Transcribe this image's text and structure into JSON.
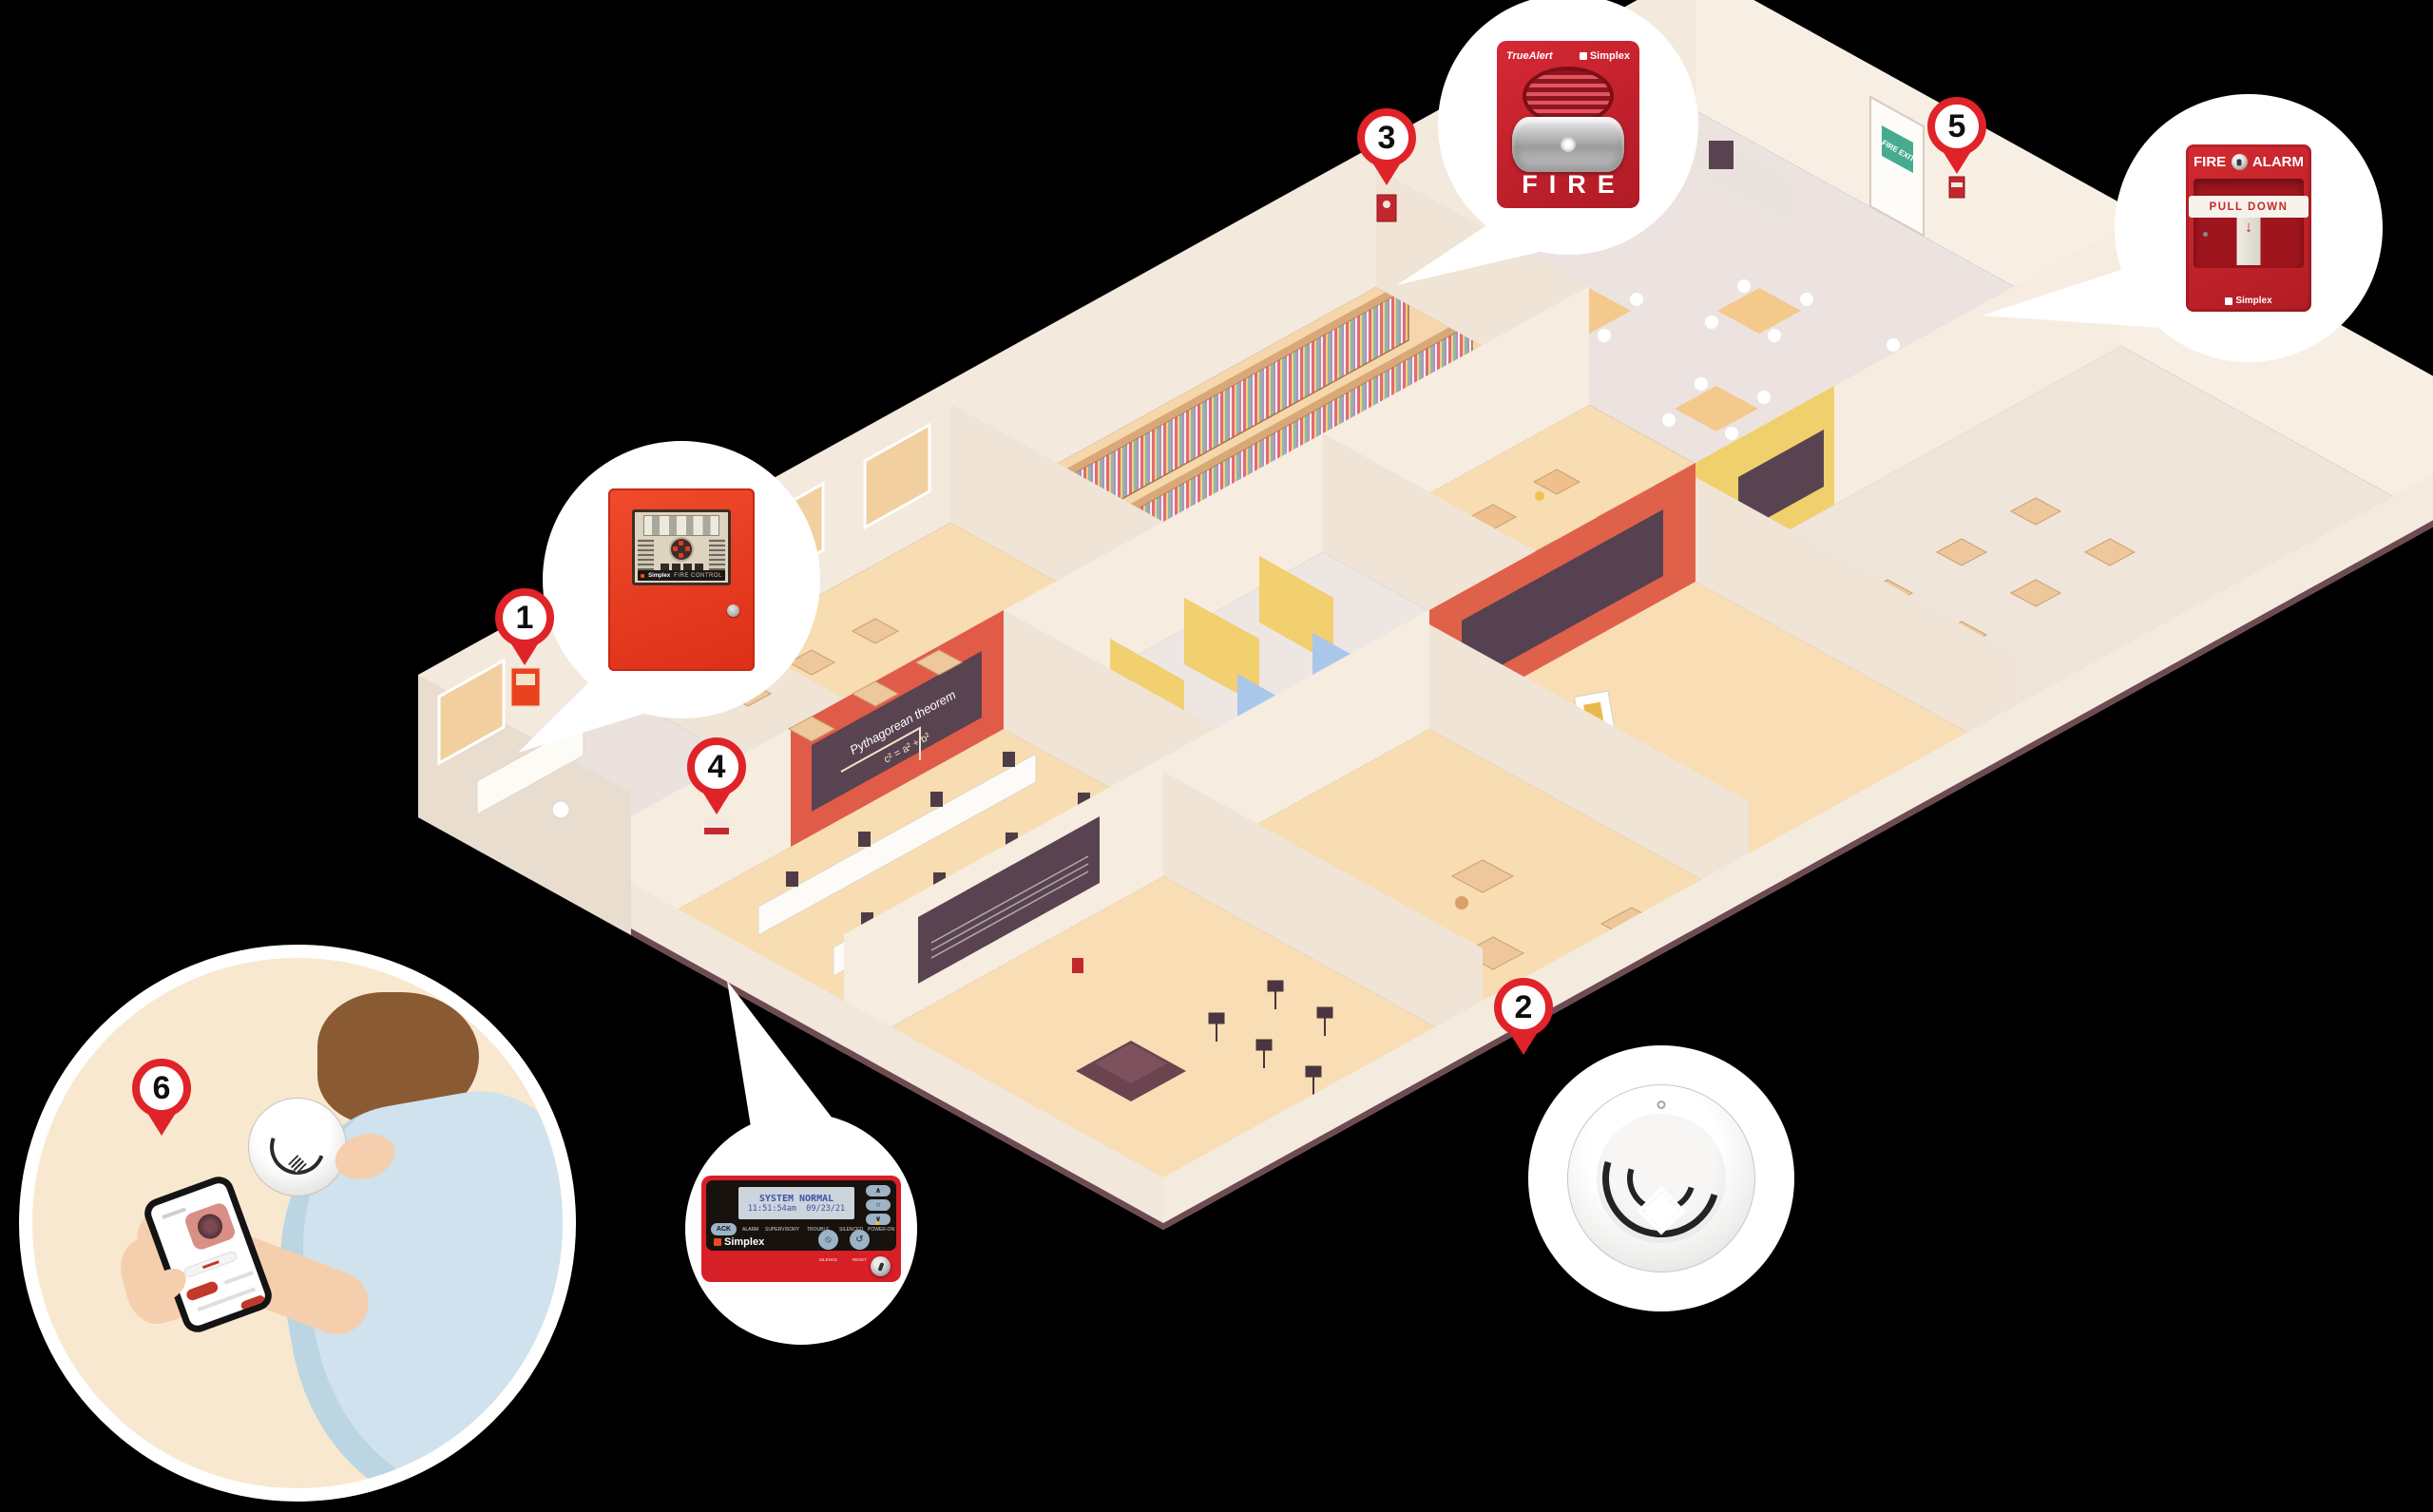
{
  "scene": {
    "background_color": "#000000",
    "markers": [
      {
        "number": "1"
      },
      {
        "number": "2"
      },
      {
        "number": "3"
      },
      {
        "number": "4"
      },
      {
        "number": "5"
      },
      {
        "number": "6"
      }
    ]
  },
  "callouts": {
    "control_panel": {
      "brand": "Simplex",
      "label": "FIRE CONTROL"
    },
    "horn_strobe": {
      "brand_left": "TrueAlert",
      "brand_right": "Simplex",
      "label": "FIRE"
    },
    "pull_station": {
      "word_left": "FIRE",
      "word_right": "ALARM",
      "instruction": "PULL DOWN",
      "arrow": "↓",
      "brand": "Simplex"
    },
    "annunciator": {
      "lcd_line1": "SYSTEM NORMAL",
      "lcd_line2": "11:51:54am  09/23/21",
      "ack_label": "ACK",
      "status_labels": [
        "ALARM",
        "SUPERVISORY",
        "TROUBLE",
        "SILENCED",
        "POWER-ON"
      ],
      "nav_buttons": [
        "∧",
        "○",
        "∨"
      ],
      "brand": "Simplex",
      "button_labels": [
        "SILENCE",
        "RESET"
      ],
      "button_glyphs": [
        "⦸",
        "↺"
      ]
    }
  },
  "building": {
    "fire_exit_sign": "FIRE EXIT",
    "chalkboard_title": "Pythagorean theorem",
    "chalkboard_formula": "c² = a² + b²"
  },
  "colors": {
    "pin_red": "#e02329",
    "panel_red": "#e23b25",
    "device_red": "#c8252c",
    "horn_red": "#cf2030",
    "accent_orange": "#e0614a",
    "wall_cream": "#f3e9dc",
    "floor_peach": "#f8dcb2",
    "callout_white": "#ffffff"
  }
}
